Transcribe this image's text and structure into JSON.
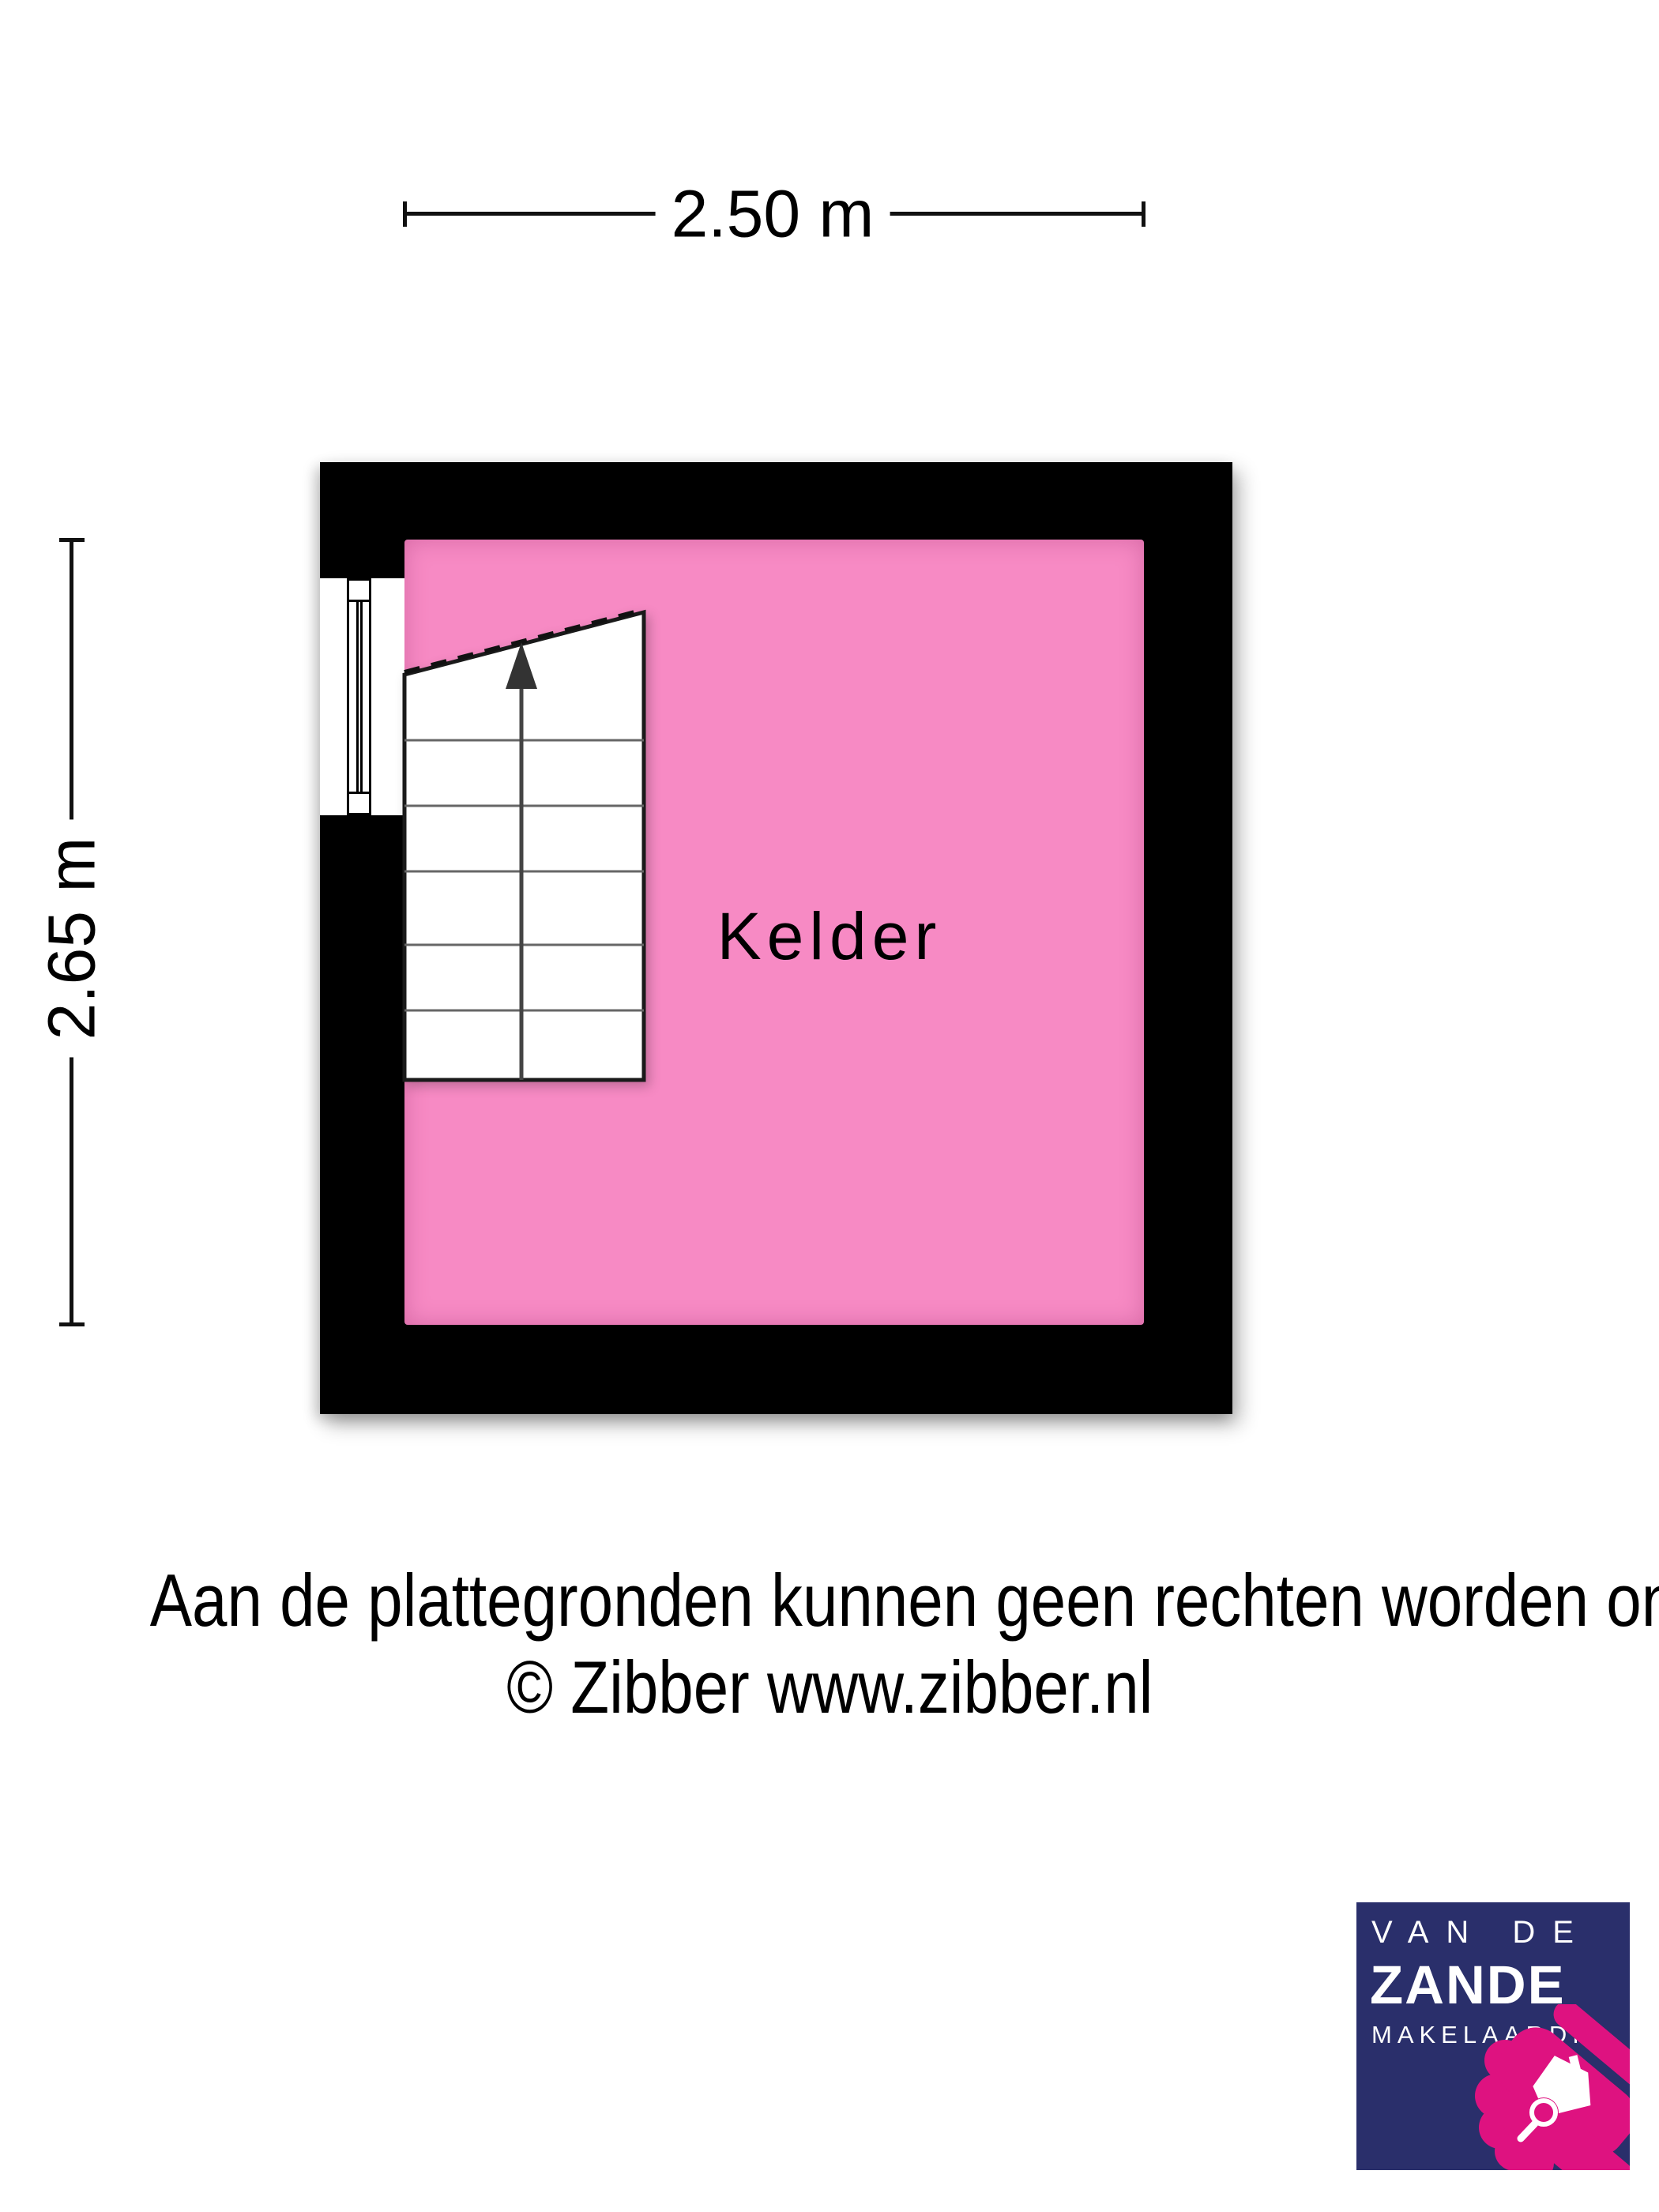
{
  "dimensions": {
    "width_label": "2.50 m",
    "height_label": "2.65 m"
  },
  "room": {
    "label": "Kelder"
  },
  "disclaimer": {
    "line1": "Aan de plattegronden kunnen geen rechten worden ontleend",
    "line2": "© Zibber www.zibber.nl"
  },
  "logo": {
    "line1": "VAN DE",
    "line2": "ZANDE",
    "line3": "MAKELAARDIJ"
  },
  "colors": {
    "floor_pink": "#f78ac4",
    "wall_black": "#000000",
    "logo_navy": "#2a2f6b",
    "logo_magenta": "#de1280",
    "tread_gray": "#666666"
  }
}
